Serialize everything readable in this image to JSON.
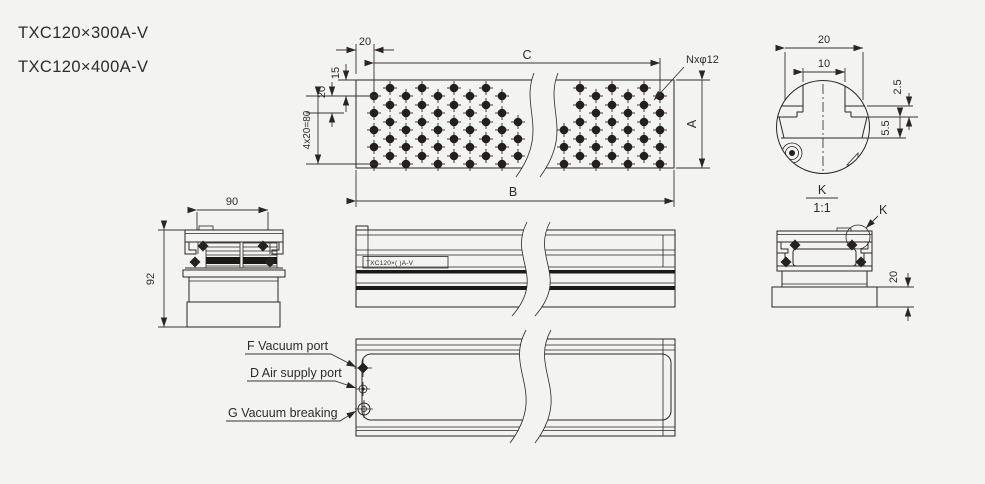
{
  "title": {
    "model_1": "TXC120×300A-V",
    "model_2": "TXC120×400A-V"
  },
  "plan_view": {
    "dim_edge_offset": "20",
    "dim_c": "C",
    "hole_callout": "Nxφ12",
    "dim_top_margin": "15",
    "dim_row_pitch": "20",
    "dim_rows_total": "4x20=80",
    "dim_width": "A",
    "dim_length": "B"
  },
  "left_end_view": {
    "dim_top_width": "90",
    "dim_height": "92"
  },
  "front_view": {
    "marking": "TXC120×(  )A-V"
  },
  "right_end_view": {
    "detail_ref": "K",
    "dim_base_height": "20",
    "detail_name": "K",
    "detail_scale": "1:1"
  },
  "detail_k": {
    "dim_outer": "20",
    "dim_slot": "10",
    "dim_lip": "2.5",
    "dim_depth": "5.5"
  },
  "bottom_view": {
    "port_f_label": "F Vacuum port",
    "port_d_label": "D Air supply port",
    "port_g_label": "G Vacuum breaking"
  },
  "colors": {
    "line": "#2b2623",
    "background": "#f3f3f1"
  }
}
